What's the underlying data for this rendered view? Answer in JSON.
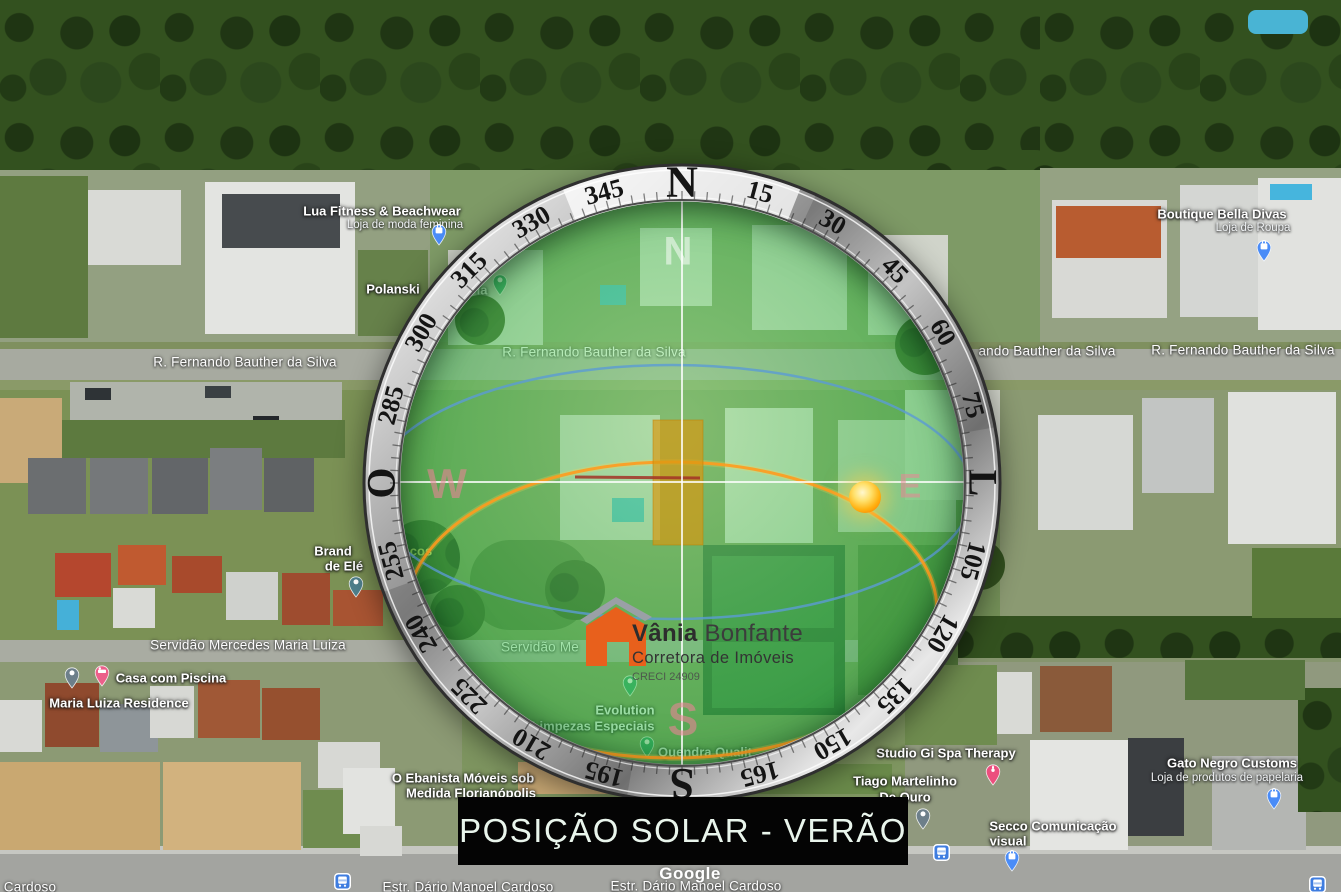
{
  "title_banner": {
    "text": "POSIÇÃO SOLAR - VERÃO",
    "bg": "#040404",
    "fg": "#e9f5ec"
  },
  "watermark": {
    "text": "Google"
  },
  "logo": {
    "name_primary": "Vânia",
    "name_secondary": "Bonfante",
    "tagline": "Corretora de Imóveis",
    "registration": "CRECI 24909",
    "house_color": "#e8601c",
    "roof_color": "#9aa0a6"
  },
  "compass": {
    "ring_labels": [
      {
        "deg": 0,
        "label": "N"
      },
      {
        "deg": 15,
        "label": "15"
      },
      {
        "deg": 30,
        "label": "30"
      },
      {
        "deg": 45,
        "label": "45"
      },
      {
        "deg": 60,
        "label": "60"
      },
      {
        "deg": 75,
        "label": "75"
      },
      {
        "deg": 90,
        "label": "L"
      },
      {
        "deg": 105,
        "label": "105"
      },
      {
        "deg": 120,
        "label": "120"
      },
      {
        "deg": 135,
        "label": "135"
      },
      {
        "deg": 150,
        "label": "150"
      },
      {
        "deg": 165,
        "label": "165"
      },
      {
        "deg": 180,
        "label": "S"
      },
      {
        "deg": 195,
        "label": "195"
      },
      {
        "deg": 210,
        "label": "210"
      },
      {
        "deg": 225,
        "label": "225"
      },
      {
        "deg": 240,
        "label": "240"
      },
      {
        "deg": 255,
        "label": "255"
      },
      {
        "deg": 270,
        "label": "O"
      },
      {
        "deg": 285,
        "label": "285"
      },
      {
        "deg": 300,
        "label": "300"
      },
      {
        "deg": 315,
        "label": "315"
      },
      {
        "deg": 330,
        "label": "330"
      },
      {
        "deg": 345,
        "label": "345"
      }
    ],
    "cardinal_watermarks": {
      "north": "N",
      "west": "W",
      "east": "E",
      "south": "S"
    },
    "sun_color": "#ffb300",
    "summer_path_color": "#ff9b1e",
    "winter_path_color": "#5b9bd5",
    "highlighted_lot_color": "#d79a1e",
    "tint_color": "#3cc350"
  },
  "map": {
    "streets": [
      {
        "text": "R. Fernando Bauther da Silva",
        "x": 245,
        "y": 362
      },
      {
        "text": "R. Fernando Bauther da Silva",
        "x": 594,
        "y": 352
      },
      {
        "text": "ando Bauther da Silva",
        "x": 1047,
        "y": 351
      },
      {
        "text": "R. Fernando Bauther da Silva",
        "x": 1243,
        "y": 350
      },
      {
        "text": "Servidão Mercedes Maria Luiza",
        "x": 248,
        "y": 645
      },
      {
        "text": "Servidão Me",
        "x": 540,
        "y": 647
      },
      {
        "text": "Cardoso",
        "x": 30,
        "y": 887
      },
      {
        "text": "Estr. Dário Manoel Cardoso",
        "x": 468,
        "y": 887
      },
      {
        "text": "Estr. Dário Manoel Cardoso",
        "x": 696,
        "y": 886
      }
    ],
    "pois": [
      {
        "id": "lua-fitness",
        "lines": [
          {
            "text": "Lua Fitness & Beachwear",
            "x": 382,
            "y": 211,
            "style": "title"
          },
          {
            "text": "Loja de moda feminina",
            "x": 405,
            "y": 225,
            "style": "sub"
          }
        ],
        "pin": {
          "kind": "shopping",
          "color": "#4a8cf7",
          "x": 439,
          "y": 246
        }
      },
      {
        "id": "polanski",
        "lines": [
          {
            "text": "Polanski",
            "x": 393,
            "y": 289,
            "style": "title"
          },
          {
            "text": "ia",
            "x": 482,
            "y": 290,
            "style": "title"
          }
        ],
        "pin": {
          "kind": "place",
          "color": "#2f9e68",
          "x": 500,
          "y": 296
        }
      },
      {
        "id": "boutique-bella-divas",
        "lines": [
          {
            "text": "Boutique Bella Divas",
            "x": 1222,
            "y": 214,
            "style": "title"
          },
          {
            "text": "Loja de Roupa",
            "x": 1253,
            "y": 228,
            "style": "sub"
          }
        ],
        "pin": {
          "kind": "shopping",
          "color": "#4a8cf7",
          "x": 1264,
          "y": 262
        }
      },
      {
        "id": "brand-eletrica",
        "lines": [
          {
            "text": "Brand",
            "x": 333,
            "y": 551,
            "style": "title"
          },
          {
            "text": "de Elé",
            "x": 344,
            "y": 566,
            "style": "title"
          },
          {
            "text": "ços",
            "x": 421,
            "y": 551,
            "style": "frag"
          }
        ],
        "pin": {
          "kind": "place",
          "color": "#4e7f8c",
          "x": 356,
          "y": 598
        }
      },
      {
        "id": "casa-com-piscina",
        "lines": [
          {
            "text": "Casa com Piscina",
            "x": 171,
            "y": 678,
            "style": "title"
          }
        ],
        "pin": {
          "kind": "lodging",
          "color": "#ec5f8a",
          "x": 102,
          "y": 687
        }
      },
      {
        "id": "maria-luiza-residence",
        "lines": [
          {
            "text": "Maria Luiza Residence",
            "x": 119,
            "y": 703,
            "style": "title"
          }
        ],
        "pin": {
          "kind": "place",
          "color": "#6d7f8a",
          "x": 72,
          "y": 689
        }
      },
      {
        "id": "evolution-limpezas",
        "lines": [
          {
            "text": "Evolution",
            "x": 625,
            "y": 710,
            "style": "title"
          },
          {
            "text": "Limpezas Especiais",
            "x": 593,
            "y": 726,
            "style": "title"
          }
        ]
      },
      {
        "id": "quendra-qualit",
        "lines": [
          {
            "text": "Quendra Qualit",
            "x": 705,
            "y": 752,
            "style": "title"
          }
        ],
        "pin": {
          "kind": "place",
          "color": "#2f9e68",
          "x": 647,
          "y": 758
        }
      },
      {
        "id": "creci-pin",
        "lines": [],
        "pin": {
          "kind": "place",
          "color": "#2f9e68",
          "x": 630,
          "y": 697
        }
      },
      {
        "id": "o-ebanista",
        "lines": [
          {
            "text": "O Ebanista Móveis sob",
            "x": 463,
            "y": 778,
            "style": "title"
          },
          {
            "text": "Medida Florianópolis",
            "x": 471,
            "y": 793,
            "style": "title"
          }
        ]
      },
      {
        "id": "studio-gi-spa",
        "lines": [
          {
            "text": "Studio Gi Spa Therapy",
            "x": 946,
            "y": 753,
            "style": "title"
          }
        ],
        "pin": {
          "kind": "spa",
          "color": "#ec4f7e",
          "x": 993,
          "y": 786
        }
      },
      {
        "id": "tiago-martelinho",
        "lines": [
          {
            "text": "Tiago Martelinho",
            "x": 905,
            "y": 781,
            "style": "title"
          },
          {
            "text": "De Ouro",
            "x": 905,
            "y": 797,
            "style": "title"
          }
        ],
        "pin": {
          "kind": "place",
          "color": "#6d7f8a",
          "x": 923,
          "y": 830
        }
      },
      {
        "id": "gato-negro-customs",
        "lines": [
          {
            "text": "Gato Negro Customs",
            "x": 1232,
            "y": 763,
            "style": "title"
          },
          {
            "text": "Loja de produtos de papelaria",
            "x": 1227,
            "y": 778,
            "style": "sub"
          }
        ],
        "pin": {
          "kind": "shopping",
          "color": "#4a8cf7",
          "x": 1274,
          "y": 810
        }
      },
      {
        "id": "secco-comunicacao",
        "lines": [
          {
            "text": "Secco Comunicação",
            "x": 1053,
            "y": 826,
            "style": "title"
          },
          {
            "text": "visual",
            "x": 1008,
            "y": 841,
            "style": "title"
          }
        ],
        "pin": {
          "kind": "shopping",
          "color": "#4a8cf7",
          "x": 1012,
          "y": 872
        }
      },
      {
        "id": "bus-stop-1",
        "lines": [],
        "pin": {
          "kind": "bus",
          "color": "#3f7de0",
          "x": 342,
          "y": 881
        }
      },
      {
        "id": "bus-stop-2",
        "lines": [],
        "pin": {
          "kind": "bus",
          "color": "#3f7de0",
          "x": 941,
          "y": 852
        }
      },
      {
        "id": "bus-stop-3",
        "lines": [],
        "pin": {
          "kind": "bus",
          "color": "#3f7de0",
          "x": 1317,
          "y": 884
        }
      }
    ]
  }
}
